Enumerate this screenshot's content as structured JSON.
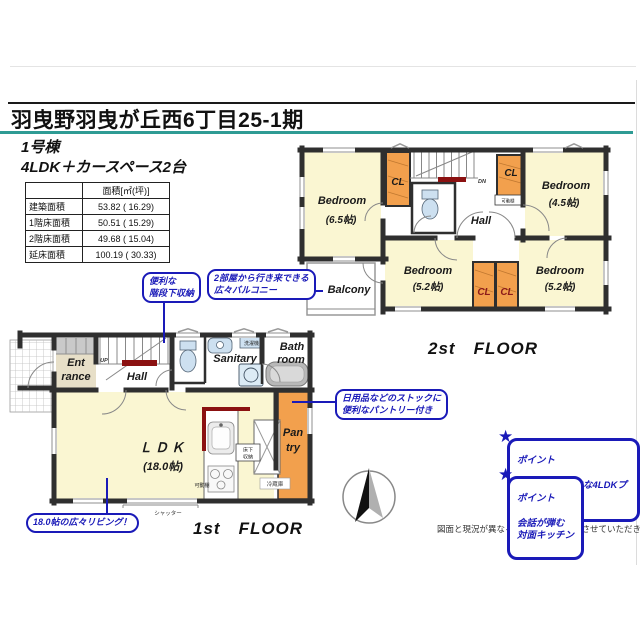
{
  "header": {
    "title": "羽曳野羽曳が丘西6丁目25-1期",
    "building": "1号棟",
    "plan": "4LDK＋カースペース2台"
  },
  "area_table": {
    "col_header": "面積[㎡(坪)]",
    "rows": [
      {
        "label": "建築面積",
        "value": "53.82 ( 16.29)"
      },
      {
        "label": "1階床面積",
        "value": "50.51 ( 15.29)"
      },
      {
        "label": "2階床面積",
        "value": "49.68 ( 15.04)"
      },
      {
        "label": "延床面積",
        "value": "100.19 ( 30.33)"
      }
    ]
  },
  "floor2": {
    "floor_label": "2st　FLOOR",
    "b1_name": "Bedroom",
    "b1_size": "(6.5帖)",
    "b2_name": "Bedroom",
    "b2_size": "(4.5帖)",
    "b3_name": "Bedroom",
    "b3_size": "(5.2帖)",
    "b4_name": "Bedroom",
    "b4_size": "(5.2帖)",
    "hall": "Hall",
    "balcony": "Balcony",
    "cl1": "CL",
    "cl2": "CL",
    "cl3": "CL",
    "cl4": "CL",
    "dn": "DN",
    "shelf": "可動棚"
  },
  "floor1": {
    "floor_label": "1st　FLOOR",
    "ent1": "Ent",
    "ent2": "rance",
    "hall": "Hall",
    "up": "UP",
    "sanitary": "Sanitary",
    "washer": "洗濯機",
    "bath1": "Bath",
    "bath2": "room",
    "ldk": "ＬＤＫ",
    "ldk_size": "(18.0帖)",
    "pantry1": "Pan",
    "pantry2": "try",
    "fs1": "床下",
    "fs2": "収納",
    "fridge": "冷蔵庫",
    "shelf": "可動棚",
    "shutter": "シャッター"
  },
  "ann": {
    "stairs": "便利な\n階段下収納",
    "balcony": "2部屋から行き来できる\n広々バルコニー",
    "pantry": "日用品などのストックに\n便利なパントリー付き",
    "living": "18.0帖の広々リビング！",
    "p1_title": "ポイント",
    "p1_body": "使い方が自由な4LDKプラン",
    "p2_title": "ポイント",
    "p2_body": "会話が弾む\n対面キッチン",
    "star": "★"
  },
  "footer": {
    "disclaimer": "図面と現況が異なる場合、現況を優先させていただきます。"
  },
  "colors": {
    "accent_blue": "#1a1ab8",
    "teal": "#2e9b94",
    "room_yellow": "#faf6d2",
    "closet_orange": "#f2a04d",
    "wall": "#2f2f2f",
    "red_accent": "#8b1111"
  }
}
